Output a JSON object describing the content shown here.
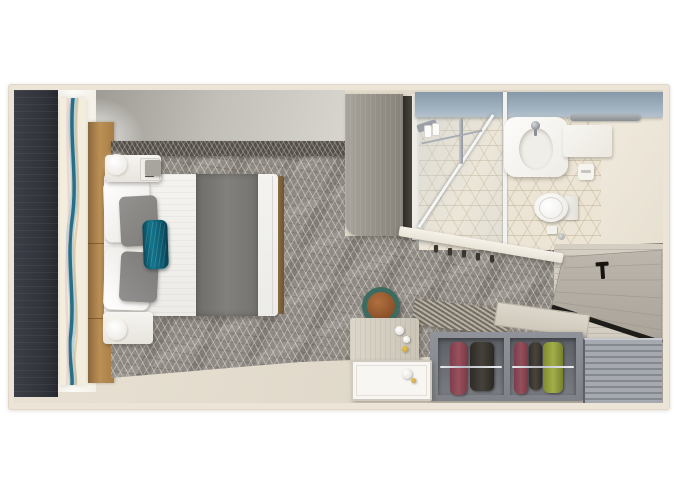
{
  "scene": {
    "label": "Top-down 3D rendered floor plan of a cruise ship stateroom",
    "style": "photorealistic aerial render, no visible text labels",
    "rooms": [
      {
        "name": "bedroom",
        "items": [
          "queen bed with white duvet",
          "charcoal gray bed runner",
          "two white pillows",
          "two gray pillows",
          "teal accent pillow",
          "white nightstand with round lamp (top)",
          "white nightstand with round lamp (bottom)",
          "geometric patterned gray carpet",
          "gold upholstered headboard wall",
          "dark charcoal wardrobe wall panel",
          "abstract blue wave art / window panel"
        ]
      },
      {
        "name": "bathroom",
        "items": [
          "angled glass shower with chrome fixtures",
          "mirror panel",
          "white basin sink with faucet",
          "steel-blue shelf band",
          "towel bar",
          "vanity shelf",
          "toilet with tank",
          "toilet paper holder",
          "cream cube-pattern tile floor"
        ]
      },
      {
        "name": "entry",
        "items": [
          "cabin door with black T-handle",
          "light wood plank floor",
          "coat hooks on angled wall",
          "shoe shelf items"
        ]
      },
      {
        "name": "closet",
        "items": [
          "slatted luggage rack top",
          "wood shelf",
          "open wardrobe bay with maroon and charcoal garments",
          "open wardrobe bay with maroon, charcoal and olive garments",
          "chrome hanging rod",
          "louvered cabinet"
        ]
      },
      {
        "name": "desk_area",
        "items": [
          "light wood desk with cups",
          "white side tray table",
          "round stool with teal rim and tan leather seat"
        ]
      }
    ],
    "palette": {
      "page_background": "#ffffff",
      "wall_cream": "#ece4d7",
      "floor_beige": "#e0d9ca",
      "carpet_gray": "#8f8a83",
      "dark_panel": "#33363e",
      "headboard_gold": "#b08a50",
      "accent_teal_pillow": "#11768c",
      "bathroom_band_blue": "#97a9b8",
      "tile_cream": "#ece5d5",
      "wardrobe_gray": "#888b91",
      "cloth_maroon": "#8e4752",
      "cloth_charcoal": "#3a362f",
      "cloth_olive": "#97a23f",
      "stool_rim_teal": "#3c6b5f",
      "stool_seat_tan": "#9a5c36",
      "door_handle_black": "#18140f"
    }
  }
}
